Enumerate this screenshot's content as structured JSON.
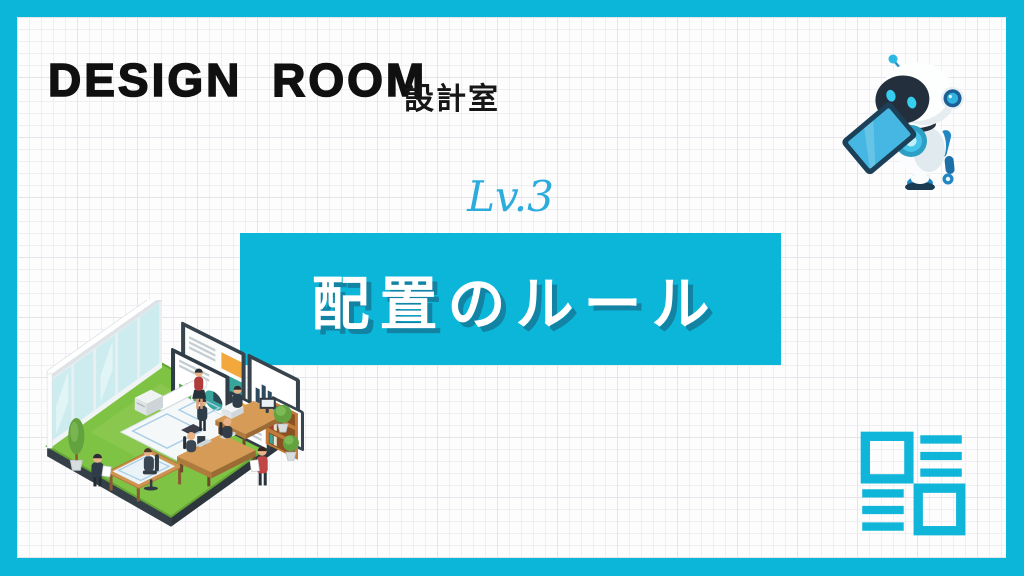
{
  "slide": {
    "header": {
      "title_en": "DESIGN ROOM",
      "title_ja": "設計室"
    },
    "level_label": "Lv.3",
    "banner": {
      "title": "配置のルール"
    },
    "icons": {
      "robot": "robot-mascot-illustration",
      "office": "isometric-design-office-illustration",
      "layout": "layout-wireframe-icon"
    },
    "colors": {
      "accent_cyan": "#0cb6d9",
      "level_cyan": "#2bacdc",
      "banner_text": "#ffffff",
      "banner_text_shadow": "#1283a3",
      "heading_black": "#101010",
      "paper": "#fdfdfd",
      "grid_line": "#e4e4ea",
      "floor_green": "#7fc344",
      "screen_frame": "#37444e",
      "wood": "#d59b57"
    }
  }
}
